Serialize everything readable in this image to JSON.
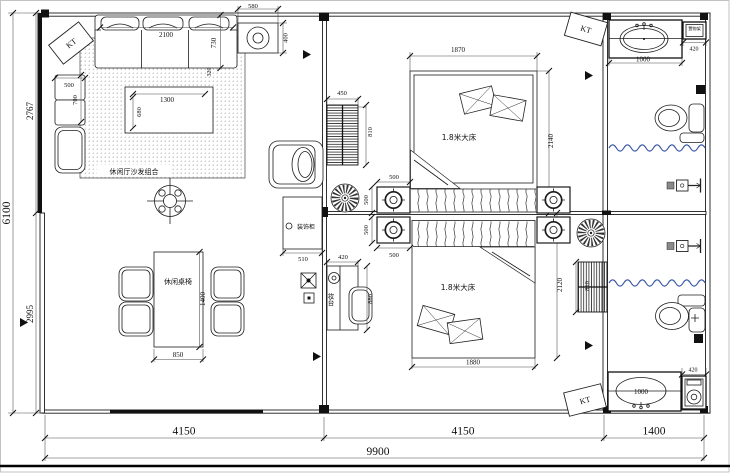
{
  "plan": {
    "type": "residential floor plan",
    "labels": {
      "kt": "KT",
      "sofa_area": "休闲厅沙发组合",
      "dining_set": "休闲桌椅",
      "bed1": "1.8米大床",
      "bed2": "1.8米大床",
      "cabinet": "装饰柜",
      "dresser": "妆台",
      "shelf": "置物架"
    },
    "dims": {
      "total_w": "9900",
      "span_living": "4150",
      "span_bedroom": "4150",
      "span_bath": "1400",
      "total_h": "6100",
      "h_top": "2767",
      "h_bottom": "2995",
      "sofa_w": "2100",
      "sofa_d": "730",
      "sofa_edge": "320",
      "vent_w": "580",
      "vent_h": "400",
      "side_w": "500",
      "side_d": "700",
      "coffee_w": "1300",
      "coffee_d": "680",
      "dining_w": "850",
      "dining_d": "1400",
      "rad1_w": "450",
      "rad1_h": "810",
      "rad2_h": "810",
      "ns_w_top": "500",
      "ns_w_bottom": "500",
      "ns_d_top": "500",
      "ns_d_bottom": "500",
      "cabinet_w": "510",
      "dresser_w": "420",
      "dresser_d": "880",
      "bed1_w": "1870",
      "bed1_l": "2140",
      "bed2_w": "1880",
      "bed2_l": "2120",
      "vanity1_w": "1000",
      "shelf1_w": "420",
      "vanity2_w": "1000",
      "shelf2_w": "420"
    }
  }
}
